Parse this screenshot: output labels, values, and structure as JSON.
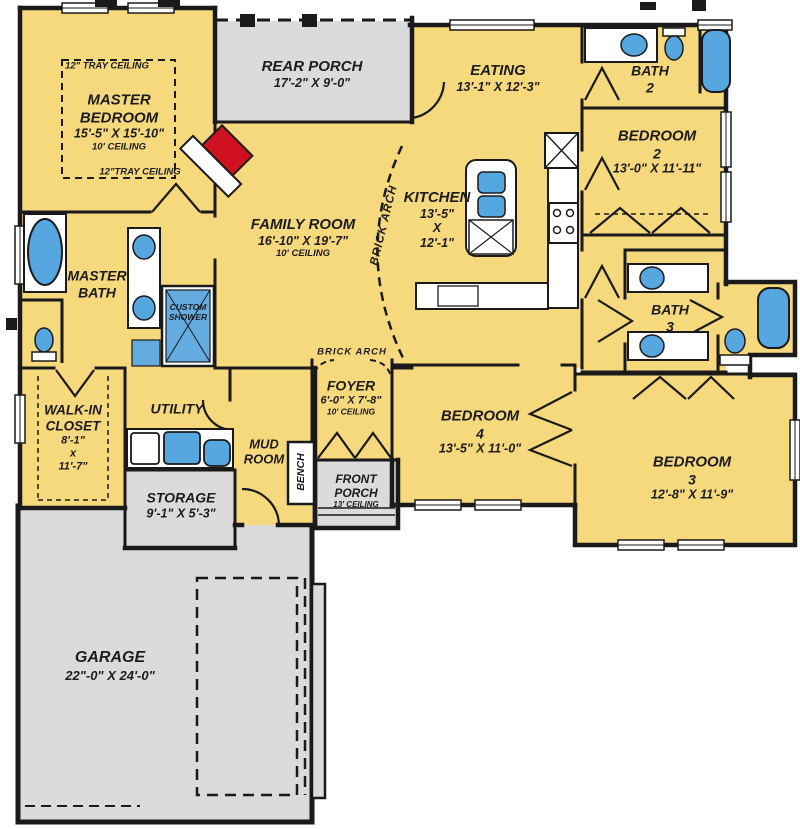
{
  "palette": {
    "room_fill": "#F6D87D",
    "porch_fill": "#DBDBDB",
    "wall": "#1a1a1a",
    "fixture_blue": "#56A6E0",
    "fireplace_red": "#CF1020"
  },
  "rooms": {
    "master_bedroom": {
      "name": "MASTER BEDROOM",
      "dims": "15'-5\" X 15'-10\"",
      "ceiling": "10' CEILING",
      "tray_top": "12\" TRAY CEILING",
      "tray_bottom": "12\"TRAY CEILING"
    },
    "rear_porch": {
      "name": "REAR PORCH",
      "dims": "17'-2\" X 9'-0\""
    },
    "eating": {
      "name": "EATING",
      "dims": "13'-1\" X 12'-3\""
    },
    "bath2": {
      "name": "BATH",
      "number": "2"
    },
    "bedroom2": {
      "name": "BEDROOM",
      "number": "2",
      "dims": "13'-0\" X 11'-11\""
    },
    "kitchen": {
      "name": "KITCHEN",
      "dim1": "13'-5\"",
      "x": "X",
      "dim2": "12'-1\""
    },
    "family_room": {
      "name": "FAMILY ROOM",
      "dims": "16'-10\" X 19'-7\"",
      "ceiling": "10' CEILING"
    },
    "master_bath": {
      "line1": "MASTER",
      "line2": "BATH"
    },
    "custom_shower": {
      "line1": "CUSTOM",
      "line2": "SHOWER"
    },
    "bath3": {
      "name": "BATH",
      "number": "3"
    },
    "walk_in_closet": {
      "line1": "WALK-IN",
      "line2": "CLOSET",
      "dim1": "8'-1\"",
      "x": "x",
      "dim2": "11'-7\""
    },
    "utility": {
      "name": "UTILITY"
    },
    "storage": {
      "name": "STORAGE",
      "dims": "9'-1\" X 5'-3\""
    },
    "mud_room": {
      "line1": "MUD",
      "line2": "ROOM"
    },
    "bench": {
      "name": "BENCH"
    },
    "foyer": {
      "name": "FOYER",
      "dims": "6'-0\" X 7'-8\"",
      "ceiling": "10' CEILING"
    },
    "front_porch": {
      "line1": "FRONT",
      "line2": "PORCH",
      "ceiling": "13' CEILING"
    },
    "bedroom4": {
      "name": "BEDROOM",
      "number": "4",
      "dims": "13'-5\" X 11'-0\""
    },
    "bedroom3": {
      "name": "BEDROOM",
      "number": "3",
      "dims": "12'-8\" X 11'-9\""
    },
    "garage": {
      "name": "GARAGE",
      "dims": "22\"-0\" X 24'-0\""
    }
  },
  "annotations": {
    "brick_arch_kitchen": "BRICK ARCH",
    "brick_arch_foyer": "BRICK ARCH"
  }
}
